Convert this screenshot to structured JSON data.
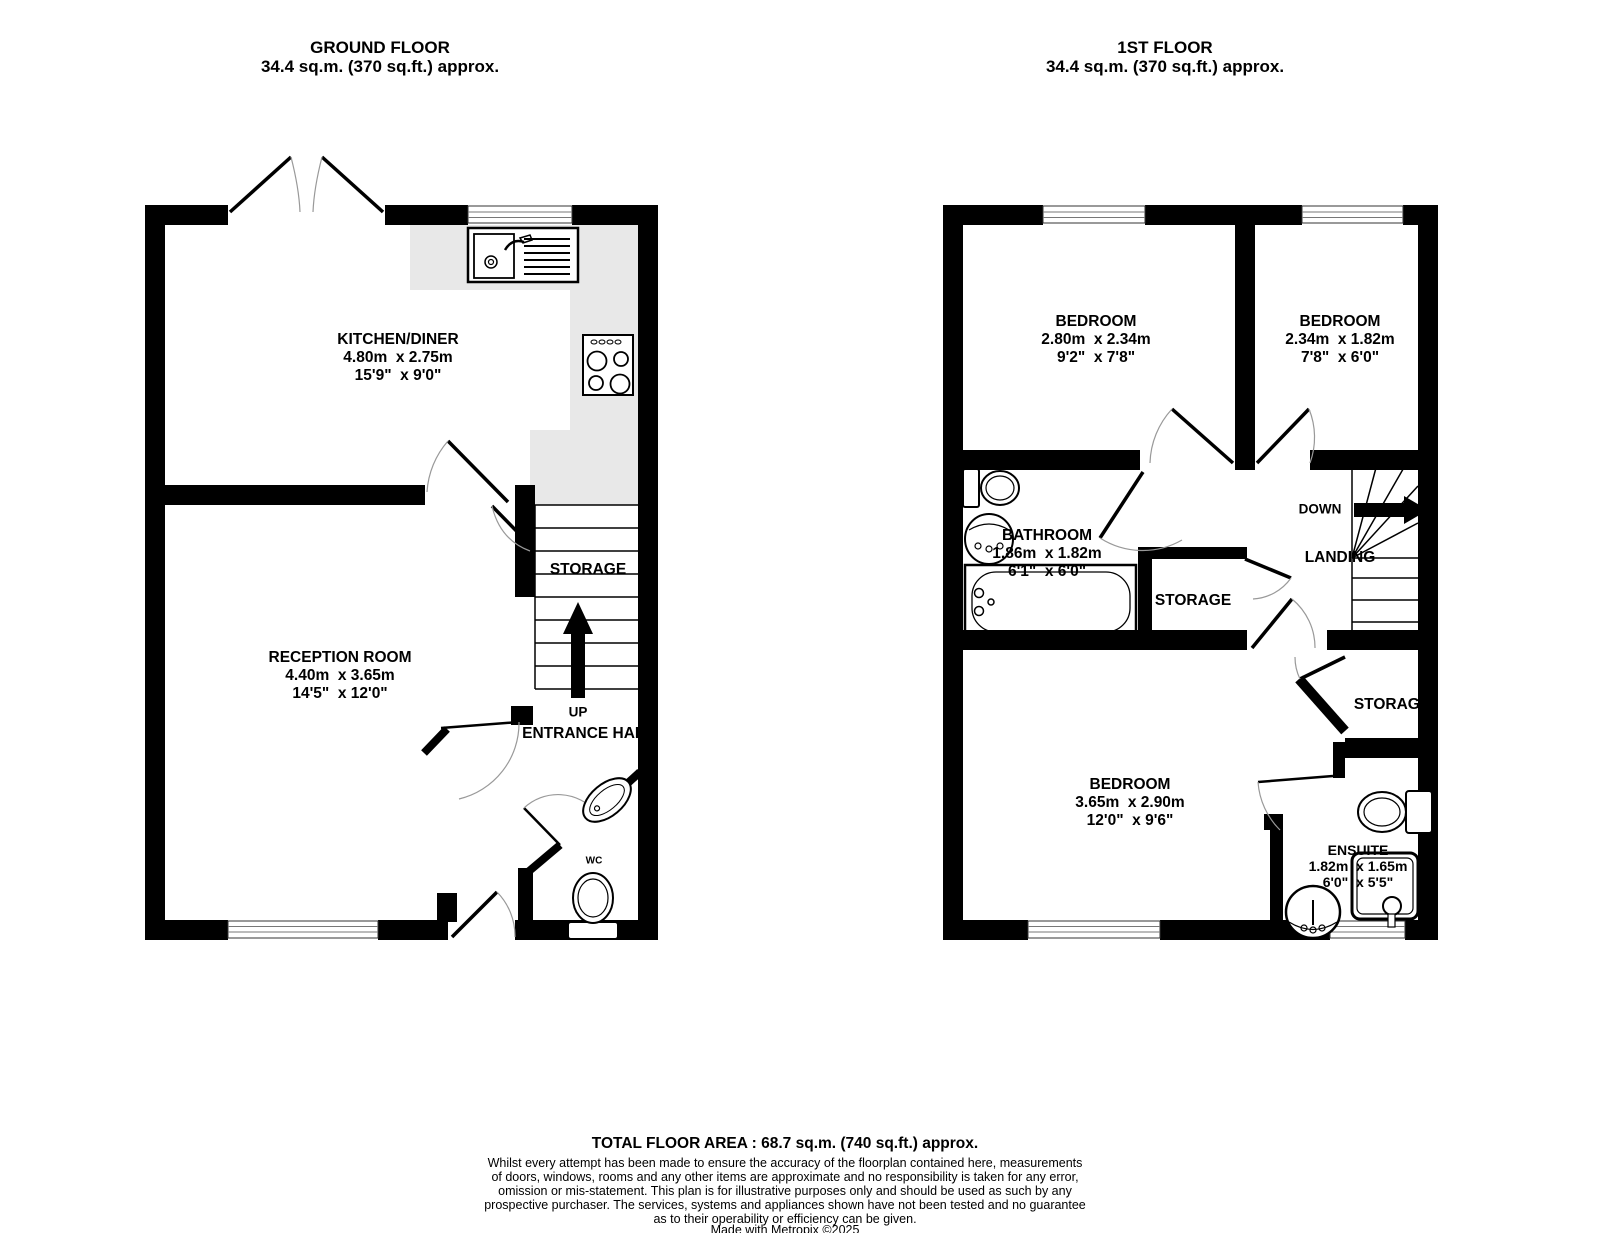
{
  "gf": {
    "title": "GROUND FLOOR",
    "area": "34.4 sq.m. (370 sq.ft.) approx.",
    "kitchen": {
      "name": "KITCHEN/DINER",
      "metric": "4.80m  x 2.75m",
      "imperial": "15'9\"  x 9'0\""
    },
    "reception": {
      "name": "RECEPTION ROOM",
      "metric": "4.40m  x 3.65m",
      "imperial": "14'5\"  x 12'0\""
    },
    "storage": "STORAGE",
    "up": "UP",
    "hall": "ENTRANCE HALL",
    "wc": "WC"
  },
  "ff": {
    "title": "1ST FLOOR",
    "area": "34.4 sq.m. (370 sq.ft.) approx.",
    "bed1": {
      "name": "BEDROOM",
      "metric": "2.80m  x 2.34m",
      "imperial": "9'2\"  x 7'8\""
    },
    "bed2": {
      "name": "BEDROOM",
      "metric": "2.34m  x 1.82m",
      "imperial": "7'8\"  x 6'0\""
    },
    "bed3": {
      "name": "BEDROOM",
      "metric": "3.65m  x 2.90m",
      "imperial": "12'0\"  x 9'6\""
    },
    "bathroom": {
      "name": "BATHROOM",
      "metric": "1.86m  x 1.82m",
      "imperial": "6'1\"  x 6'0\""
    },
    "ensuite": {
      "name": "ENSUITE",
      "metric": "1.82m  x 1.65m",
      "imperial": "6'0\"  x 5'5\""
    },
    "storage_mid": "STORAGE",
    "storage_br": "STORAGE",
    "down": "DOWN",
    "landing": "LANDING"
  },
  "footer": {
    "total": "TOTAL FLOOR AREA : 68.7 sq.m. (740 sq.ft.) approx.",
    "disclaimer": [
      "Whilst every attempt has been made to ensure the accuracy of the floorplan contained here, measurements",
      "of doors, windows, rooms and any other items are approximate and no responsibility is taken for any error,",
      "omission or mis-statement. This plan is for illustrative purposes only and should be used as such by any",
      "prospective purchaser. The services, systems and appliances shown have not been tested and no guarantee",
      "as to their operability or efficiency can be given."
    ],
    "credit": "Made with Metropix ©2025"
  }
}
